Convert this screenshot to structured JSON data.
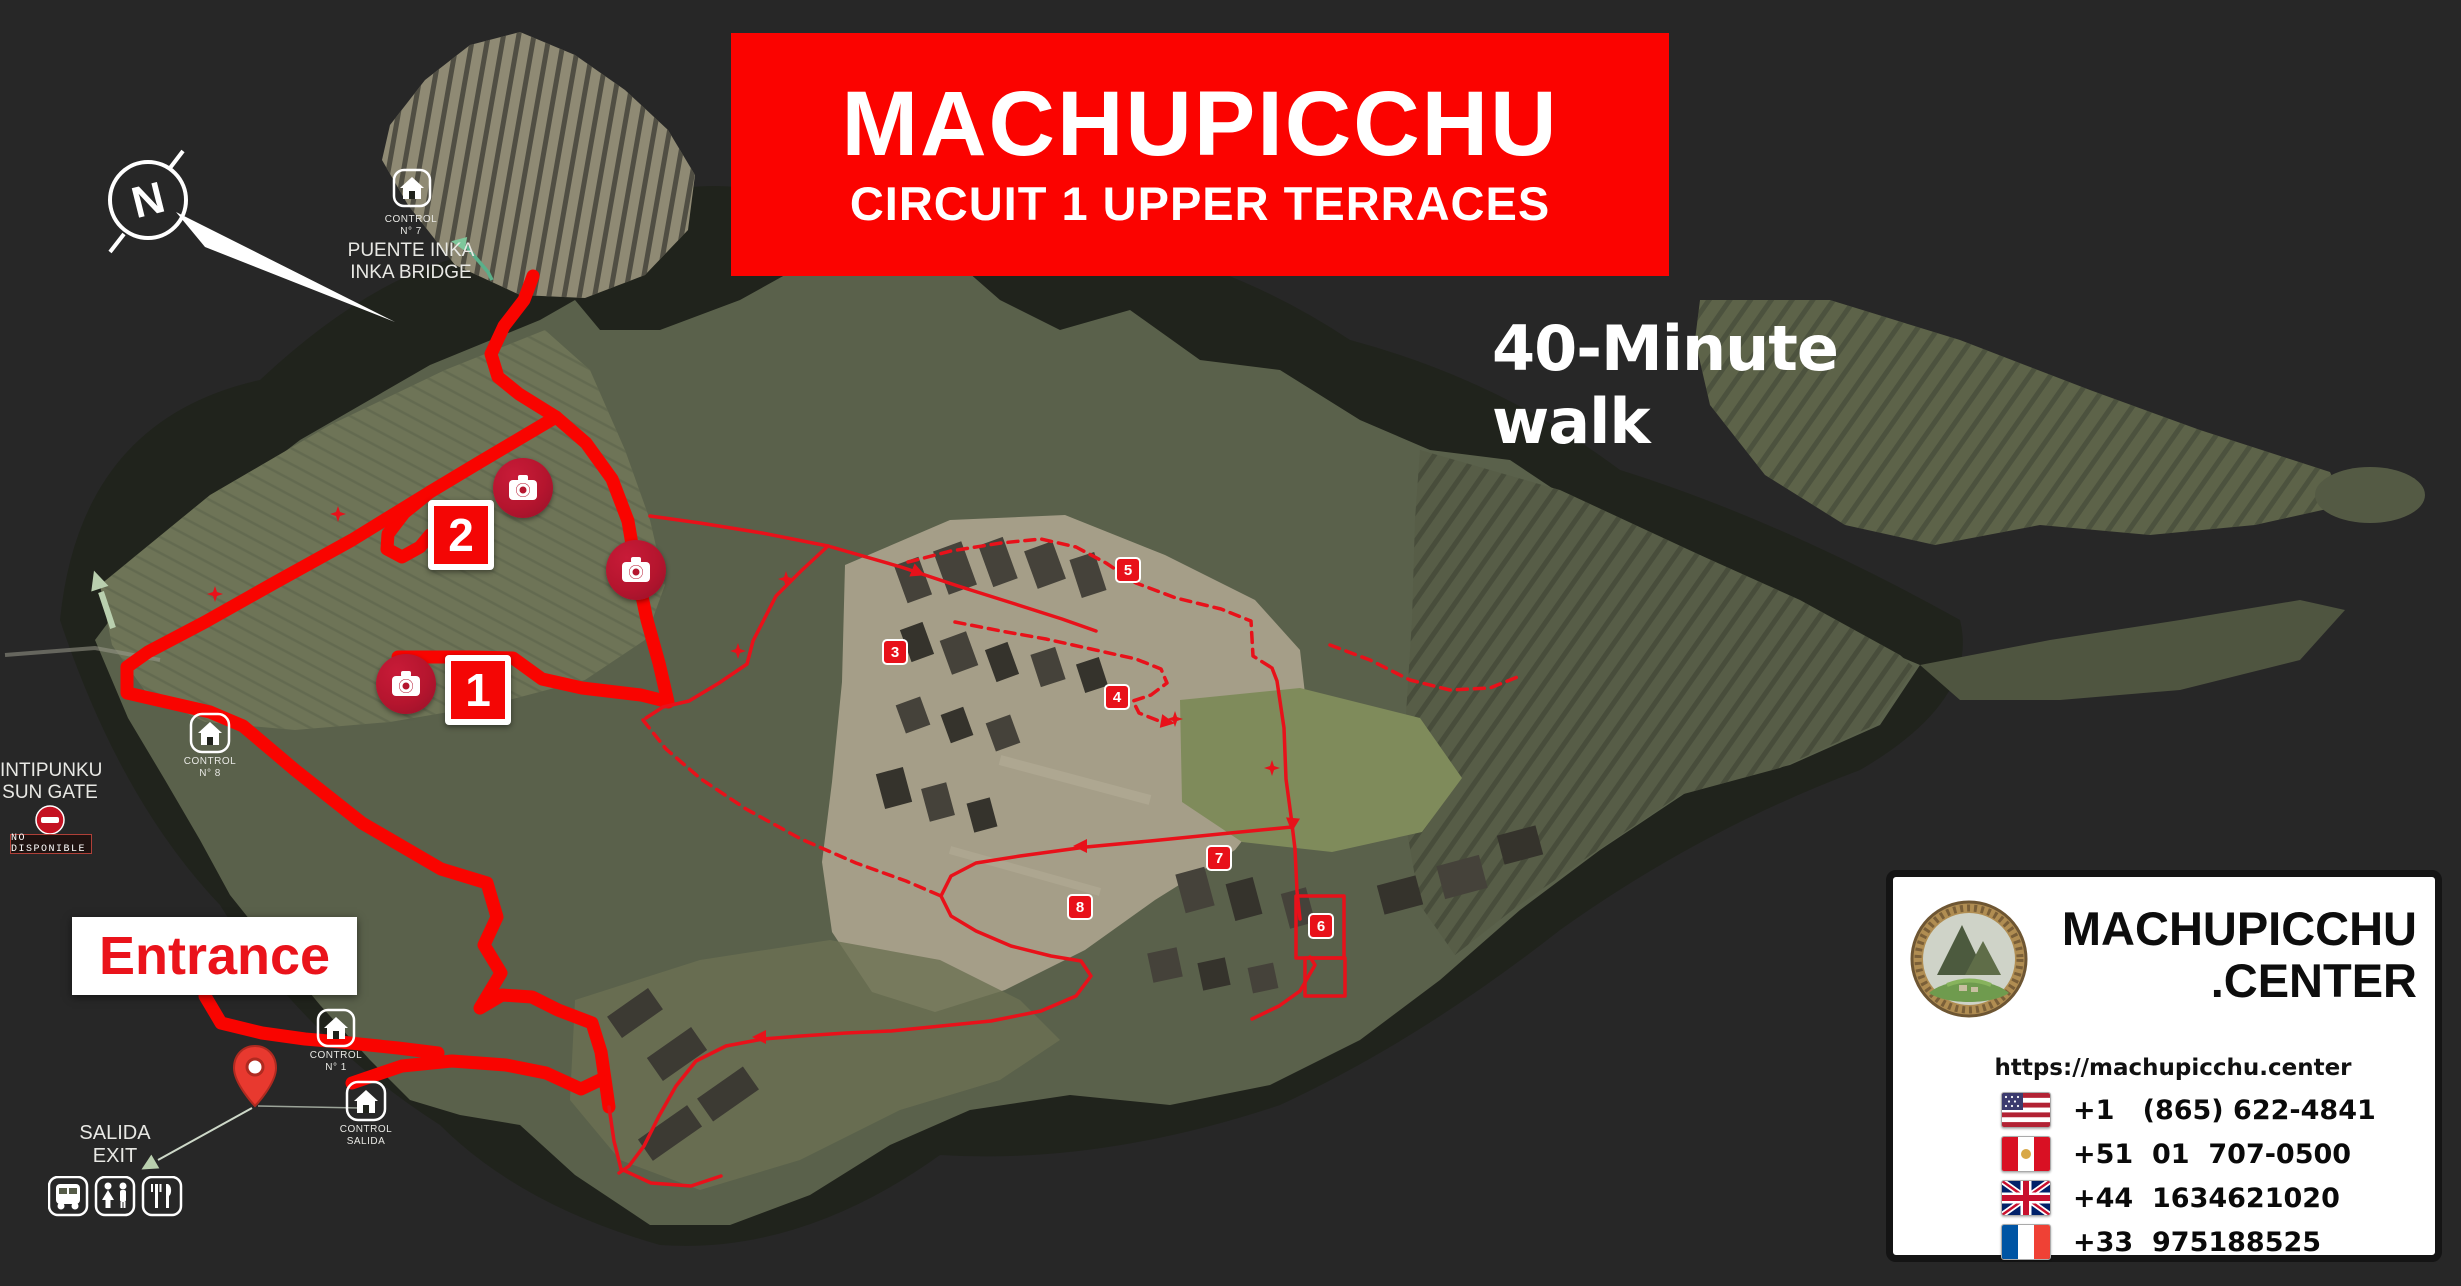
{
  "title": {
    "line1": "MACHUPICCHU",
    "line2": "CIRCUIT 1 UPPER TERRACES"
  },
  "subtitle": "40-Minute walk",
  "compass": {
    "letter": "N"
  },
  "labels": {
    "inka_bridge": {
      "control": "CONTROL",
      "control_no": "N° 7",
      "line1": "PUENTE INKA",
      "line2": "INKA BRIDGE"
    },
    "sun_gate": {
      "line1": "INTIPUNKU",
      "line2": "SUN GATE",
      "badge": "NO DISPONIBLE"
    },
    "entrance": "Entrance",
    "exit": {
      "line1": "SALIDA",
      "line2": "EXIT"
    },
    "control_8": {
      "line1": "CONTROL",
      "line2": "N° 8"
    },
    "control_1": {
      "line1": "CONTROL",
      "line2": "N° 1"
    },
    "control_salida": {
      "line1": "CONTROL",
      "line2": "SALIDA"
    }
  },
  "markers": {
    "stop1": "1",
    "stop2": "2",
    "badges": [
      "3",
      "4",
      "5",
      "6",
      "7",
      "8"
    ]
  },
  "icons": {
    "compass-icon": "north arrow in circle",
    "camera-icon": "white camera on crimson circle (photo viewpoint)",
    "control-house-icon": "white outlined house in rounded square (checkpoint)",
    "no-entry-icon": "red circle with white bar",
    "pin-icon": "red map location pin",
    "bus-icon": "bus service",
    "restroom-icon": "restrooms",
    "dining-icon": "fork and knife restaurant",
    "flag-us-icon": "USA flag",
    "flag-pe-icon": "Peru flag",
    "flag-gb-icon": "UK flag",
    "flag-fr-icon": "France flag"
  },
  "info_card": {
    "brand_line1": "MACHUPICCHU",
    "brand_line2": ".CENTER",
    "website": "https://machupicchu.center",
    "phones": [
      {
        "flag": "us",
        "number": "+1   (865) 622-4841"
      },
      {
        "flag": "pe",
        "number": "+51  01  707-0500"
      },
      {
        "flag": "gb",
        "number": "+44  1634621020"
      },
      {
        "flag": "fr",
        "number": "+33  975188525"
      }
    ]
  },
  "colors": {
    "banner_red": "#fb0300",
    "route_red": "#f90400",
    "thin_route_red": "#e8111a",
    "background": "#272727",
    "camera_badge": "#b5152e"
  }
}
